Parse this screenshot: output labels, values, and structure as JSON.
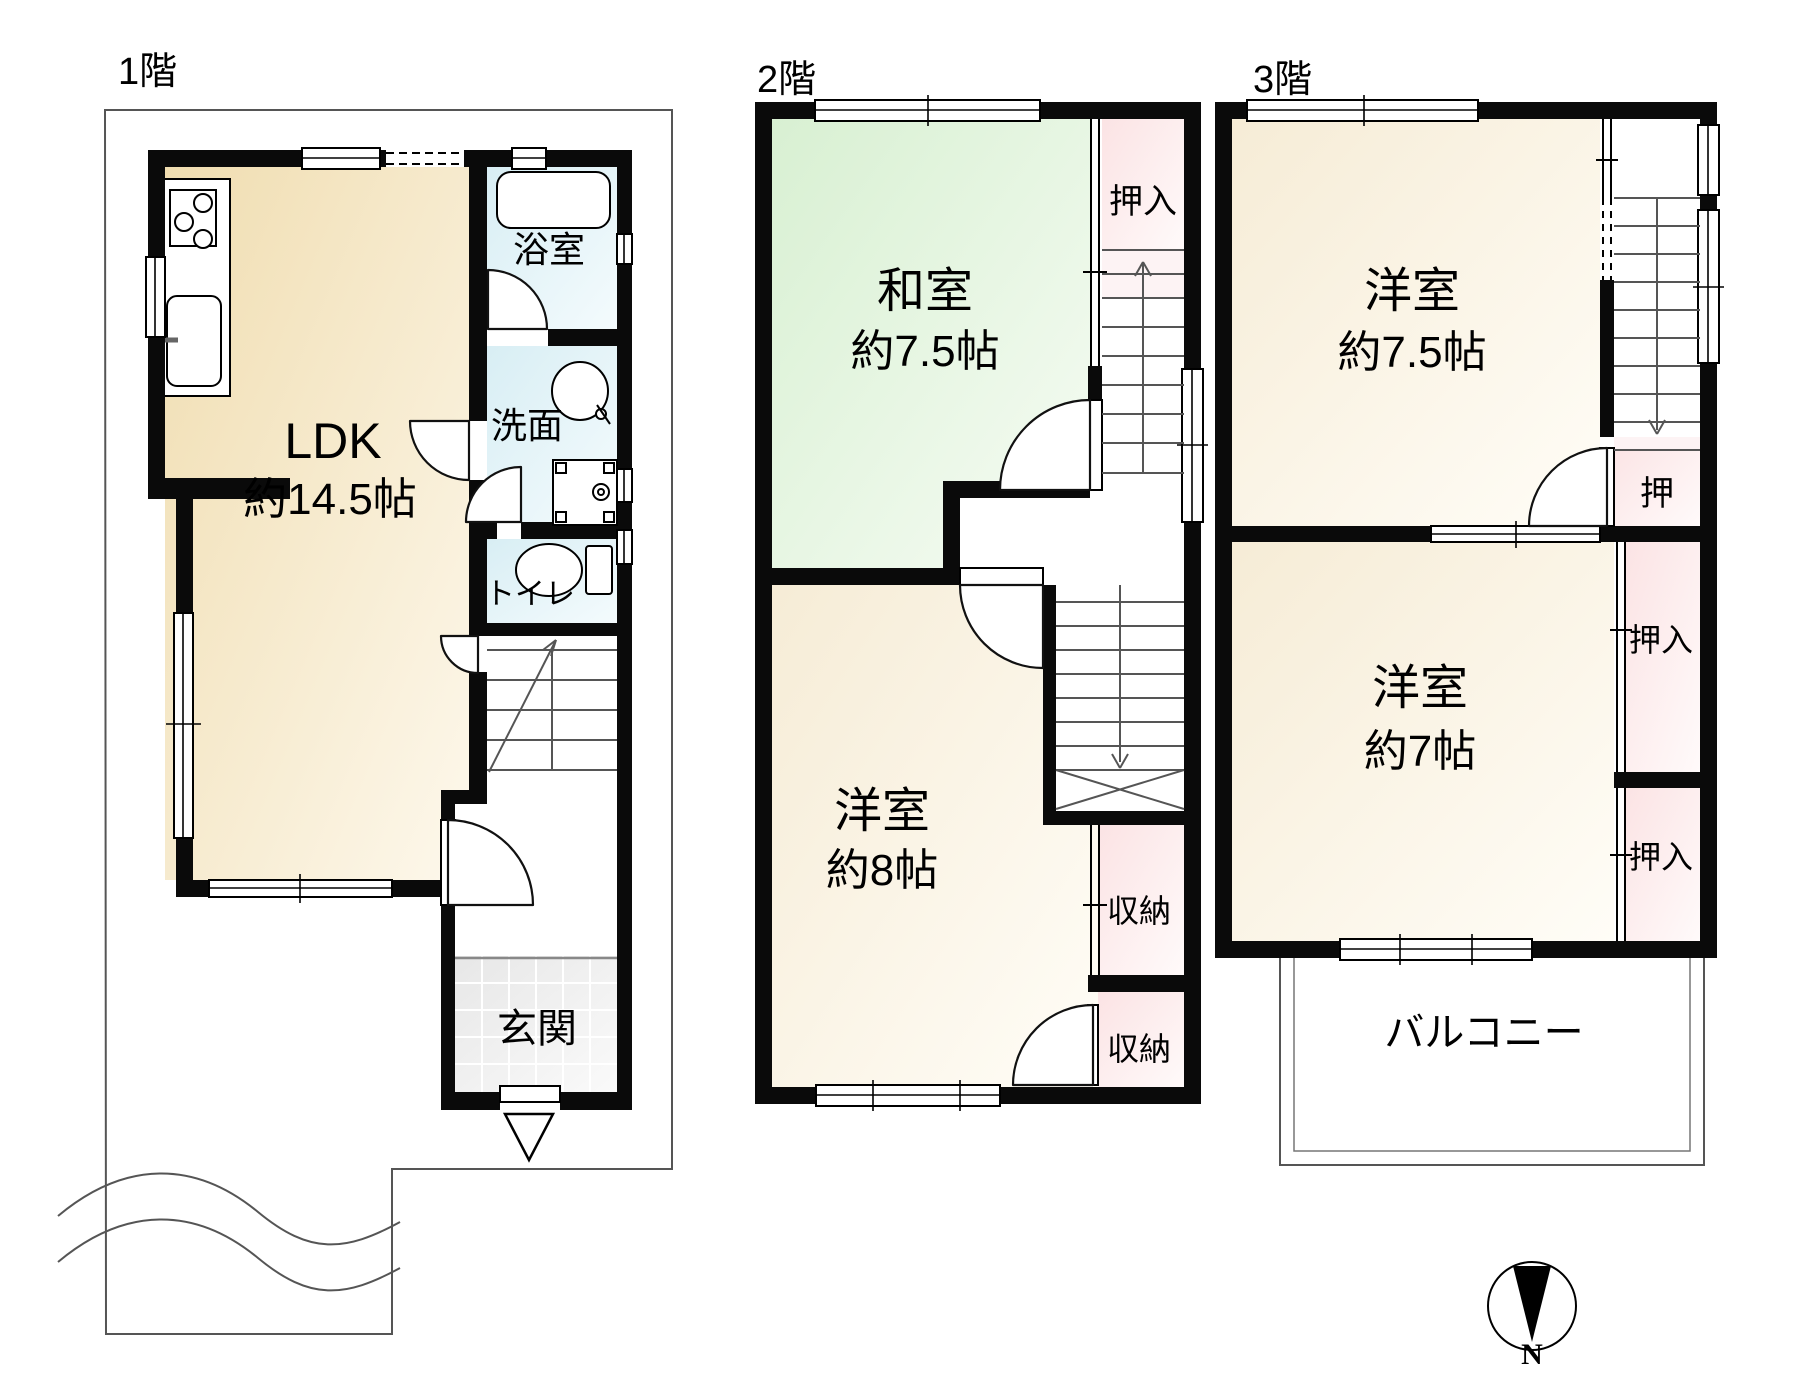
{
  "floors": {
    "f1": {
      "title": "1階",
      "ldk_name": "LDK",
      "ldk_size": "約14.5帖",
      "bath": "浴室",
      "washroom": "洗面",
      "toilet": "トイレ",
      "entrance": "玄関"
    },
    "f2": {
      "title": "2階",
      "washitsu_name": "和室",
      "washitsu_size": "約7.5帖",
      "oshiire": "押入",
      "yoshitsu_name": "洋室",
      "yoshitsu_size": "約8帖",
      "storage_upper": "収納",
      "storage_lower": "収納"
    },
    "f3": {
      "title": "3階",
      "room1_name": "洋室",
      "room1_size": "約7.5帖",
      "oshi": "押",
      "oshiire_upper": "押入",
      "room2_name": "洋室",
      "room2_size": "約7帖",
      "oshiire_lower": "押入",
      "balcony": "バルコニー"
    },
    "compass": {
      "north": "N"
    }
  },
  "colors": {
    "wall": "#0a0a0a",
    "ldk_cream": "#f2e2ba",
    "room_cream": "#f7efdd",
    "tatami_green": "#dcf2d7",
    "wet_cyan": "#ddf1f6",
    "closet_pink": "#fbe7e8",
    "tile_gray": "#e9e9e9"
  }
}
